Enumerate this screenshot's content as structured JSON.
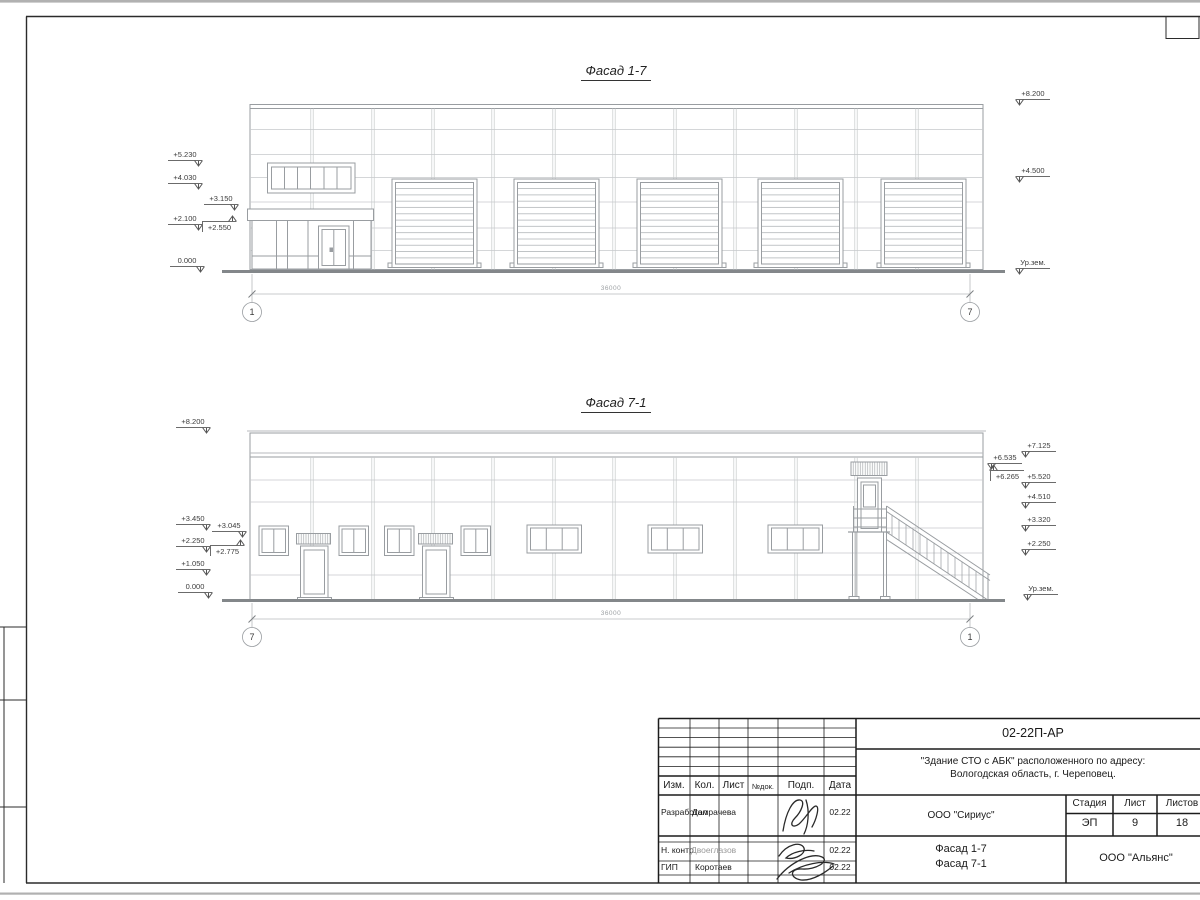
{
  "facade_top": {
    "title": "Фасад 1-7",
    "dim": "36000",
    "axis_left": "1",
    "axis_right": "7",
    "marks_left": [
      "+5.230",
      "+4.030",
      "+3.150",
      "+2.100",
      "+2.550",
      "0.000"
    ],
    "marks_right": [
      "+8.200",
      "+4.500",
      "Ур.зем."
    ]
  },
  "facade_bottom": {
    "title": "Фасад 7-1",
    "dim": "36000",
    "axis_left": "7",
    "axis_right": "1",
    "marks_left": [
      "+8.200",
      "+3.450",
      "+3.045",
      "+2.250",
      "+2.775",
      "+1.050",
      "0.000"
    ],
    "marks_right": [
      "+7.125",
      "+6.535",
      "+6.265",
      "+5.520",
      "+4.510",
      "+3.320",
      "+2.250",
      "Ур.зем."
    ]
  },
  "title_block": {
    "doc_code": "02-22П-АР",
    "project_address_line1": "\"Здание СТО с АБК\" расположенного по адресу:",
    "project_address_line2": "Вологодская область, г. Череповец.",
    "col_headers": {
      "izm": "Изм.",
      "kol": "Кол.",
      "list": "Лист",
      "ndok": "№док.",
      "podp": "Подп.",
      "data": "Дата"
    },
    "roles": [
      {
        "role": "Разработал",
        "name": "Домрачева",
        "date": "02.22"
      },
      {
        "role": "Н. контр.",
        "name": "Двоеглазов",
        "date": "02.22"
      },
      {
        "role": "ГИП",
        "name": "Коротаев",
        "date": "02.22"
      }
    ],
    "org_design": "ООО \"Сириус\"",
    "stage_header": "Стадия",
    "sheet_header": "Лист",
    "sheets_header": "Листов",
    "stage": "ЭП",
    "sheet_number": "9",
    "sheets_total": "18",
    "drawing_title_line1": "Фасад 1-7",
    "drawing_title_line2": "Фасад 7-1",
    "org_contractor": "ООО \"Альянс\""
  }
}
